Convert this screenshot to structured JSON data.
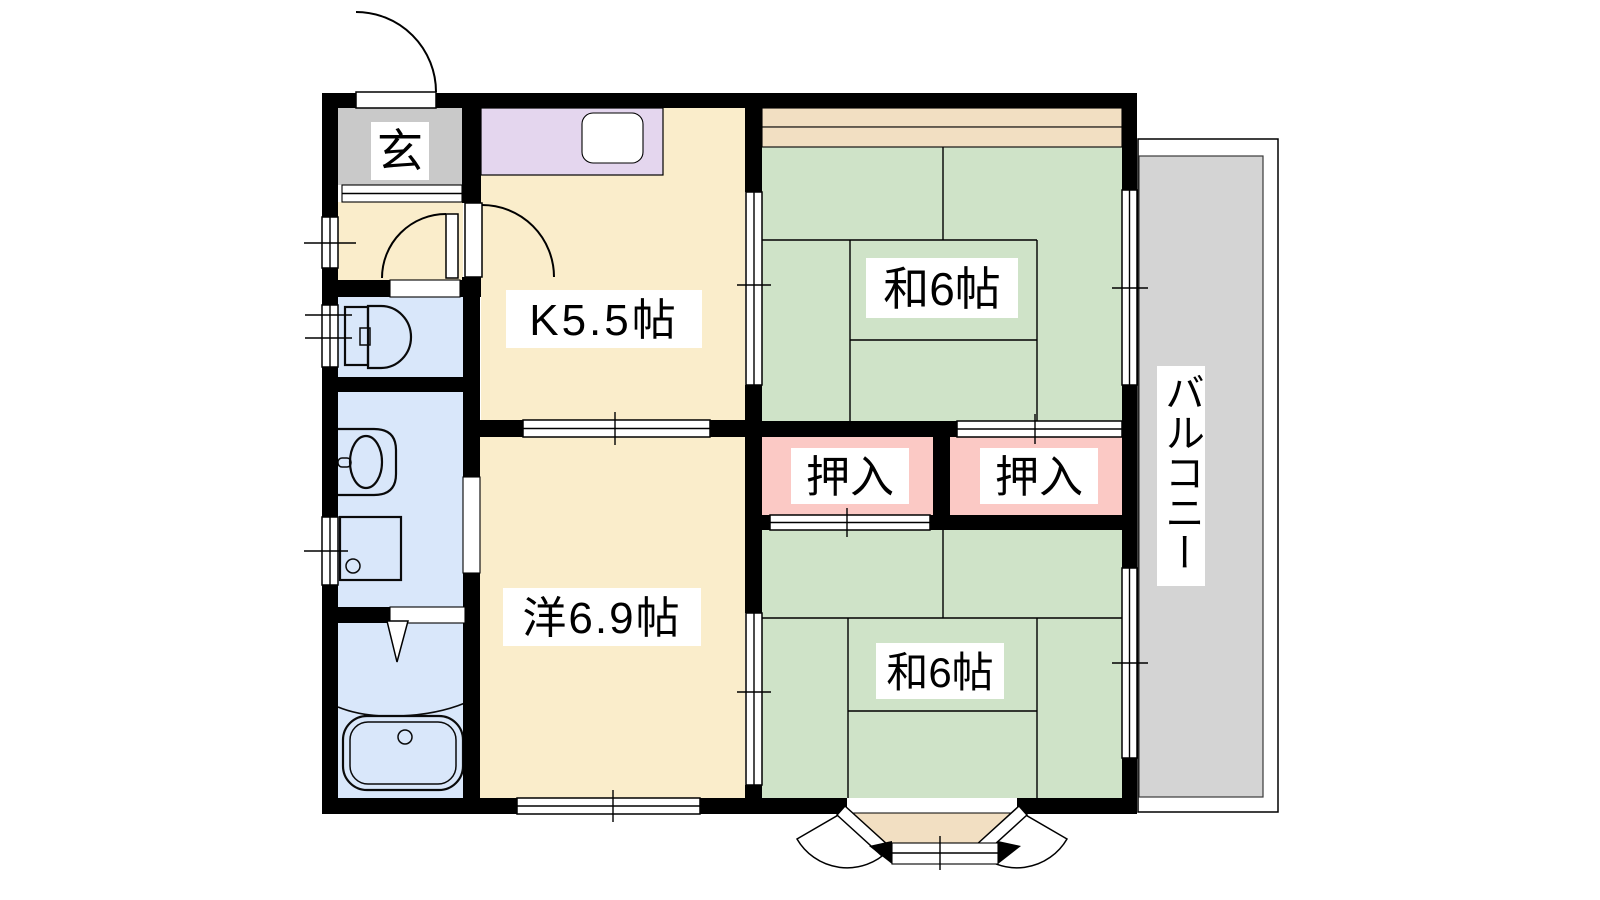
{
  "rooms": {
    "genkan": {
      "label": "玄"
    },
    "kitchen": {
      "label": "K5.5帖"
    },
    "japanese_room_top": {
      "label": "和6帖"
    },
    "japanese_room_bottom": {
      "label": "和6帖"
    },
    "western_room": {
      "label": "洋6.9帖"
    },
    "closet_left": {
      "label": "押入"
    },
    "closet_right": {
      "label": "押入"
    },
    "balcony": {
      "label": "バルコニー"
    }
  },
  "colors": {
    "wall": "#000000",
    "floor_cream": "#faedcb",
    "tatami_green": "#cfe3c8",
    "closet_pink": "#fbc9c5",
    "counter_purple": "#e4d6ee",
    "genkan_gray": "#c9c9c9",
    "balcony_gray": "#d4d4d4",
    "wet_area_blue": "#d9e7fa",
    "alcove_beige": "#f2dfc2"
  }
}
